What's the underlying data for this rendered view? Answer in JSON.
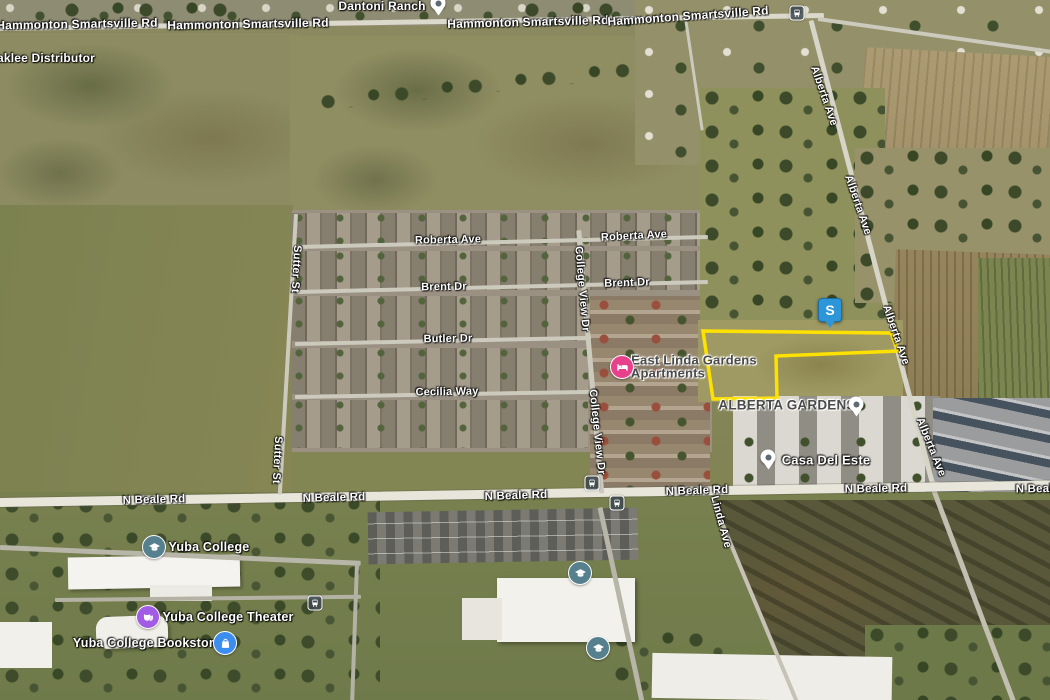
{
  "map": {
    "description": "Aerial satellite map with highlighted property parcel",
    "parcel": {
      "outline_color": "#FFE100",
      "points": [
        [
          703,
          331
        ],
        [
          891,
          333
        ],
        [
          898,
          351
        ],
        [
          776,
          356
        ],
        [
          777,
          398
        ],
        [
          713,
          399
        ]
      ]
    },
    "property_marker": {
      "label": "S",
      "x": 830,
      "y": 310,
      "color": "#2D96D9"
    },
    "road_labels": [
      {
        "text": "Hammonton Smartsville Rd",
        "x": 77,
        "y": 24,
        "rot": -1,
        "size": 12
      },
      {
        "text": "Hammonton Smartsville Rd",
        "x": 248,
        "y": 24,
        "rot": -1,
        "size": 12
      },
      {
        "text": "Hammonton Smartsville Rd",
        "x": 528,
        "y": 22,
        "rot": -1.5,
        "size": 12
      },
      {
        "text": "Hammonton Smartsville Rd",
        "x": 688,
        "y": 16,
        "rot": -4,
        "size": 12
      },
      {
        "text": "Roberta Ave",
        "x": 448,
        "y": 240,
        "rot": -1,
        "size": 11
      },
      {
        "text": "Roberta Ave",
        "x": 634,
        "y": 236,
        "rot": -3,
        "size": 11
      },
      {
        "text": "Brent Dr",
        "x": 444,
        "y": 287,
        "rot": -1,
        "size": 11
      },
      {
        "text": "Brent Dr",
        "x": 627,
        "y": 283,
        "rot": -2,
        "size": 11
      },
      {
        "text": "Butler Dr",
        "x": 448,
        "y": 339,
        "rot": -1,
        "size": 11
      },
      {
        "text": "Cecilia Way",
        "x": 447,
        "y": 392,
        "rot": -1,
        "size": 11
      },
      {
        "text": "Sutter St",
        "x": 296,
        "y": 269,
        "rot": 93,
        "size": 11
      },
      {
        "text": "Sutter St",
        "x": 277,
        "y": 460,
        "rot": 93,
        "size": 11
      },
      {
        "text": "College View Dr",
        "x": 582,
        "y": 289,
        "rot": 85,
        "size": 11
      },
      {
        "text": "College View Dr",
        "x": 597,
        "y": 432,
        "rot": 84,
        "size": 11
      },
      {
        "text": "Alberta Ave",
        "x": 824,
        "y": 96,
        "rot": 71,
        "size": 11
      },
      {
        "text": "Alberta Ave",
        "x": 858,
        "y": 205,
        "rot": 71,
        "size": 11
      },
      {
        "text": "Alberta Ave",
        "x": 896,
        "y": 335,
        "rot": 71,
        "size": 11
      },
      {
        "text": "Alberta Ave",
        "x": 931,
        "y": 447,
        "rot": 68,
        "size": 11
      },
      {
        "text": "Linda Ave",
        "x": 721,
        "y": 522,
        "rot": 75,
        "size": 11
      },
      {
        "text": "N Beale Rd",
        "x": 154,
        "y": 500,
        "rot": -1.5,
        "size": 11.5
      },
      {
        "text": "N Beale Rd",
        "x": 334,
        "y": 498,
        "rot": -1.5,
        "size": 11.5
      },
      {
        "text": "N Beale Rd",
        "x": 516,
        "y": 496,
        "rot": -2,
        "size": 11.5
      },
      {
        "text": "N Beale Rd",
        "x": 697,
        "y": 491,
        "rot": -2,
        "size": 11.5
      },
      {
        "text": "N Beale Rd",
        "x": 876,
        "y": 489,
        "rot": -1,
        "size": 11.5
      },
      {
        "text": "N Beale Rd",
        "x": 1047,
        "y": 489,
        "rot": -1,
        "size": 11.5
      }
    ],
    "place_labels": [
      {
        "text": "Dantoni Ranch",
        "x": 382,
        "y": 6,
        "tone": "light",
        "size": 12
      },
      {
        "text": "aklee Distributor",
        "x": 46,
        "y": 58,
        "tone": "light",
        "size": 12
      },
      {
        "text": "East Linda Gardens",
        "x": 694,
        "y": 360,
        "tone": "dark",
        "size": 13
      },
      {
        "text": "Apartments",
        "x": 668,
        "y": 373,
        "tone": "dark",
        "size": 13
      },
      {
        "text": "ALBERTA GARDENS",
        "x": 787,
        "y": 405,
        "tone": "dark",
        "size": 13.5
      },
      {
        "text": "Casa Del Este",
        "x": 826,
        "y": 460,
        "tone": "light",
        "size": 13
      },
      {
        "text": "Yuba College",
        "x": 209,
        "y": 547,
        "tone": "light",
        "size": 12.5
      },
      {
        "text": "Yuba College Theater",
        "x": 228,
        "y": 617,
        "tone": "light",
        "size": 12.5
      },
      {
        "text": "Yuba College Bookstore",
        "x": 147,
        "y": 643,
        "tone": "light",
        "size": 12.5
      }
    ],
    "poi_pins": [
      {
        "name": "dantoni-ranch-pin",
        "x": 438,
        "y": 3
      },
      {
        "name": "alberta-gardens-pin",
        "x": 856,
        "y": 404
      },
      {
        "name": "casa-del-este-pin",
        "x": 768,
        "y": 457
      }
    ],
    "category_markers": [
      {
        "icon": "lodging",
        "x": 622,
        "y": 367,
        "color": "#E8418C"
      },
      {
        "icon": "school",
        "x": 154,
        "y": 547,
        "color": "#56808E"
      },
      {
        "icon": "school",
        "x": 580,
        "y": 573,
        "color": "#56808E"
      },
      {
        "icon": "school",
        "x": 598,
        "y": 648,
        "color": "#56808E"
      },
      {
        "icon": "theater",
        "x": 148,
        "y": 617,
        "color": "#A15BE4"
      },
      {
        "icon": "shopping",
        "x": 225,
        "y": 643,
        "color": "#3C8DF0"
      }
    ],
    "transit_markers": [
      {
        "x": 797,
        "y": 13
      },
      {
        "x": 592,
        "y": 483
      },
      {
        "x": 617,
        "y": 503
      },
      {
        "x": 315,
        "y": 603
      }
    ]
  }
}
